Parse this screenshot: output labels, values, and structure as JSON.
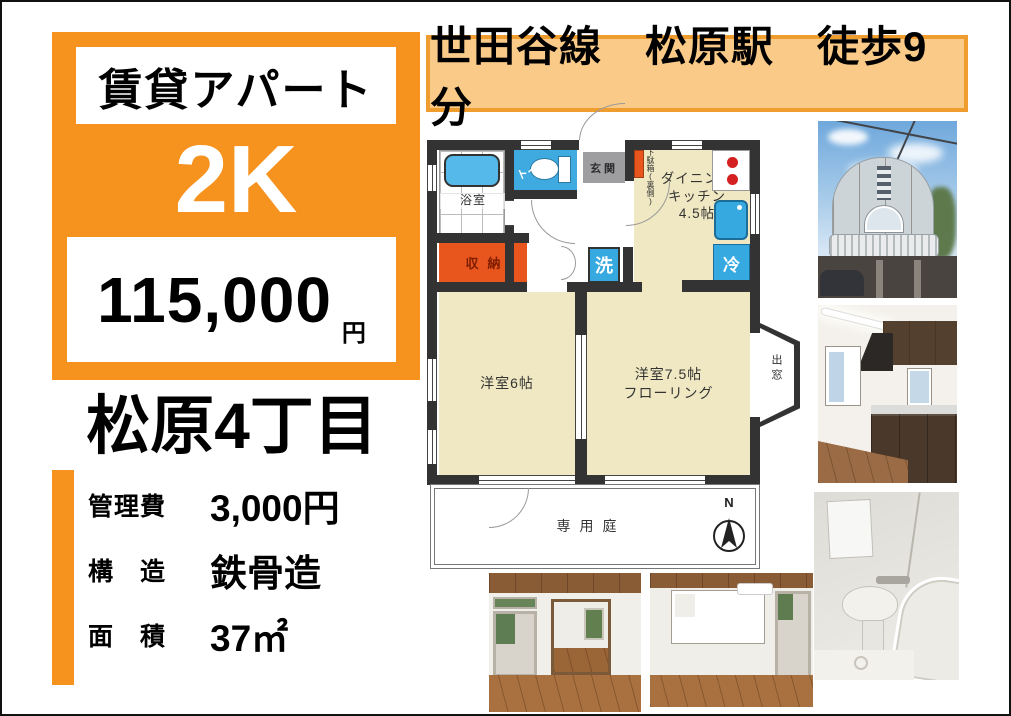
{
  "colors": {
    "accent_orange": "#F6921E",
    "banner_bg": "#FACB88",
    "banner_border": "#EF9D2F",
    "room_cream": "#EFE8C2",
    "fixture_blue": "#35A9E0",
    "storage_orange": "#E8561E",
    "wall_dark": "#333333"
  },
  "left_panel": {
    "type_label": "賃貸アパート",
    "layout": "2K",
    "price": "115,000",
    "price_unit": "円",
    "address": "松原4丁目",
    "details": [
      {
        "label": "管理費",
        "value": "3,000円"
      },
      {
        "label": "構　造",
        "value": "鉄骨造"
      },
      {
        "label": "面　積",
        "value": "37㎡"
      }
    ]
  },
  "banner": {
    "text": "世田谷線　松原駅　徒歩9分"
  },
  "floorplan": {
    "bathroom_label": "浴室",
    "toilet_label": "トイレ",
    "entrance_label": "玄関",
    "shoebox_label": "下駄箱(裏側)",
    "dk_label": "ダイニング\nキッチン\n4.5帖",
    "storage_label": "収納",
    "washer_label": "洗",
    "fridge_label": "冷",
    "room1_label": "洋室6帖",
    "room2_label": "洋室7.5帖\nフローリング",
    "bay_window_label": "出窓",
    "garden_label": "専用庭",
    "compass_label": "N"
  },
  "photos": [
    {
      "name": "building-exterior"
    },
    {
      "name": "kitchen"
    },
    {
      "name": "bathroom"
    },
    {
      "name": "interior-room-1"
    },
    {
      "name": "interior-room-2"
    }
  ]
}
